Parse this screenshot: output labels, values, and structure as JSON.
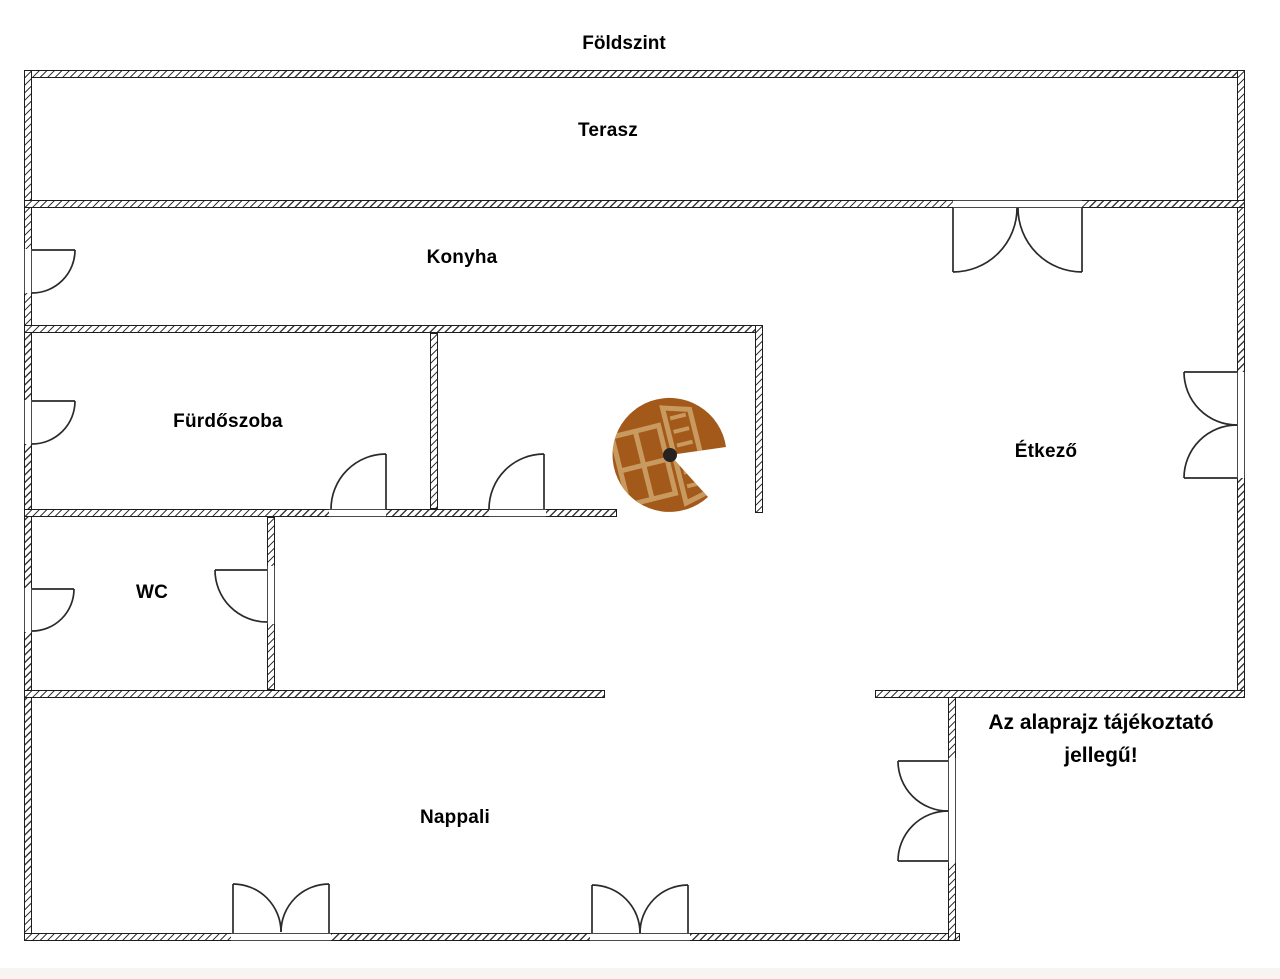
{
  "page": {
    "title": "Földszint",
    "background_color": "#ffffff",
    "footer_strip_color": "#f7f5f4"
  },
  "floor_plan": {
    "rooms": [
      {
        "name": "terasz",
        "label": "Terasz"
      },
      {
        "name": "konyha",
        "label": "Konyha"
      },
      {
        "name": "furdoszoba",
        "label": "Fürdőszoba"
      },
      {
        "name": "etkezo",
        "label": "Étkező"
      },
      {
        "name": "wc",
        "label": "WC"
      },
      {
        "name": "nappali",
        "label": "Nappali"
      }
    ],
    "disclaimer": "Az alaprajz tájékoztató jellegű!",
    "staircase_icon": {
      "name": "spiral-staircase-icon",
      "body_color": "#a3591a",
      "detail_color": "#c99a5f",
      "hub_color": "#26221f"
    },
    "wall_style": {
      "outline_color": "#1d1d1d",
      "hatch_color": "#3a3a3a",
      "door_line_color": "#2a2a2a"
    }
  }
}
